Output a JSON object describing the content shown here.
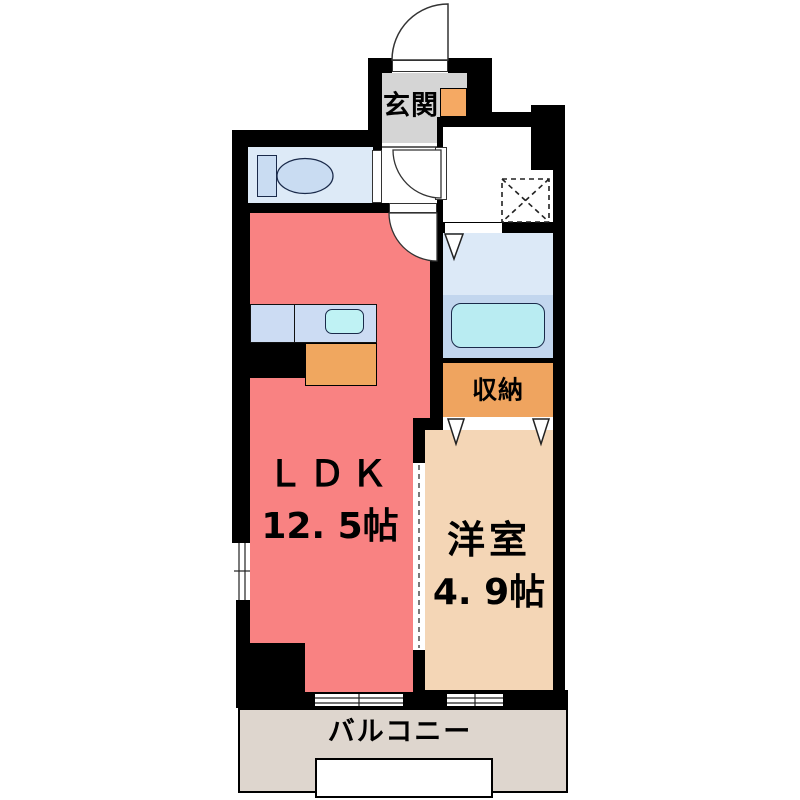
{
  "title": "apartment-floor-plan",
  "rooms": {
    "genkan": {
      "label": "玄関",
      "color": "#d5d5d5"
    },
    "ldk": {
      "label": "ＬＤＫ",
      "area": "12. 5帖",
      "color": "#f98282"
    },
    "yoshitsu": {
      "label": "洋室",
      "area": "4. 9帖",
      "color": "#f4d6b6"
    },
    "shuno": {
      "label": "収納",
      "color": "#efa45f"
    },
    "balcony": {
      "label": "バルコニー",
      "color": "#ded6ce"
    },
    "toilet_room": {
      "color": "#ddeaf7"
    },
    "washroom": {
      "color": "#ffffff"
    },
    "bathroom": {
      "color_upper": "#dce9f7",
      "color_lower": "#c2d6ee"
    }
  },
  "fixtures": {
    "toilet": {
      "color": "#c9dcf2"
    },
    "bathtub": {
      "color": "#b9ecf2"
    },
    "kitchen_counter": {
      "color": "#ccdcf3"
    },
    "kitchen_sink": {
      "color": "#bff2f4"
    },
    "kitchen_cabinet": {
      "color": "#f0a75f"
    },
    "shoe_cabinet": {
      "color": "#f5a963"
    },
    "washing_machine_space": {
      "style": "dashed-x-box"
    }
  },
  "colors": {
    "wall": "#000000",
    "background": "#ffffff"
  }
}
